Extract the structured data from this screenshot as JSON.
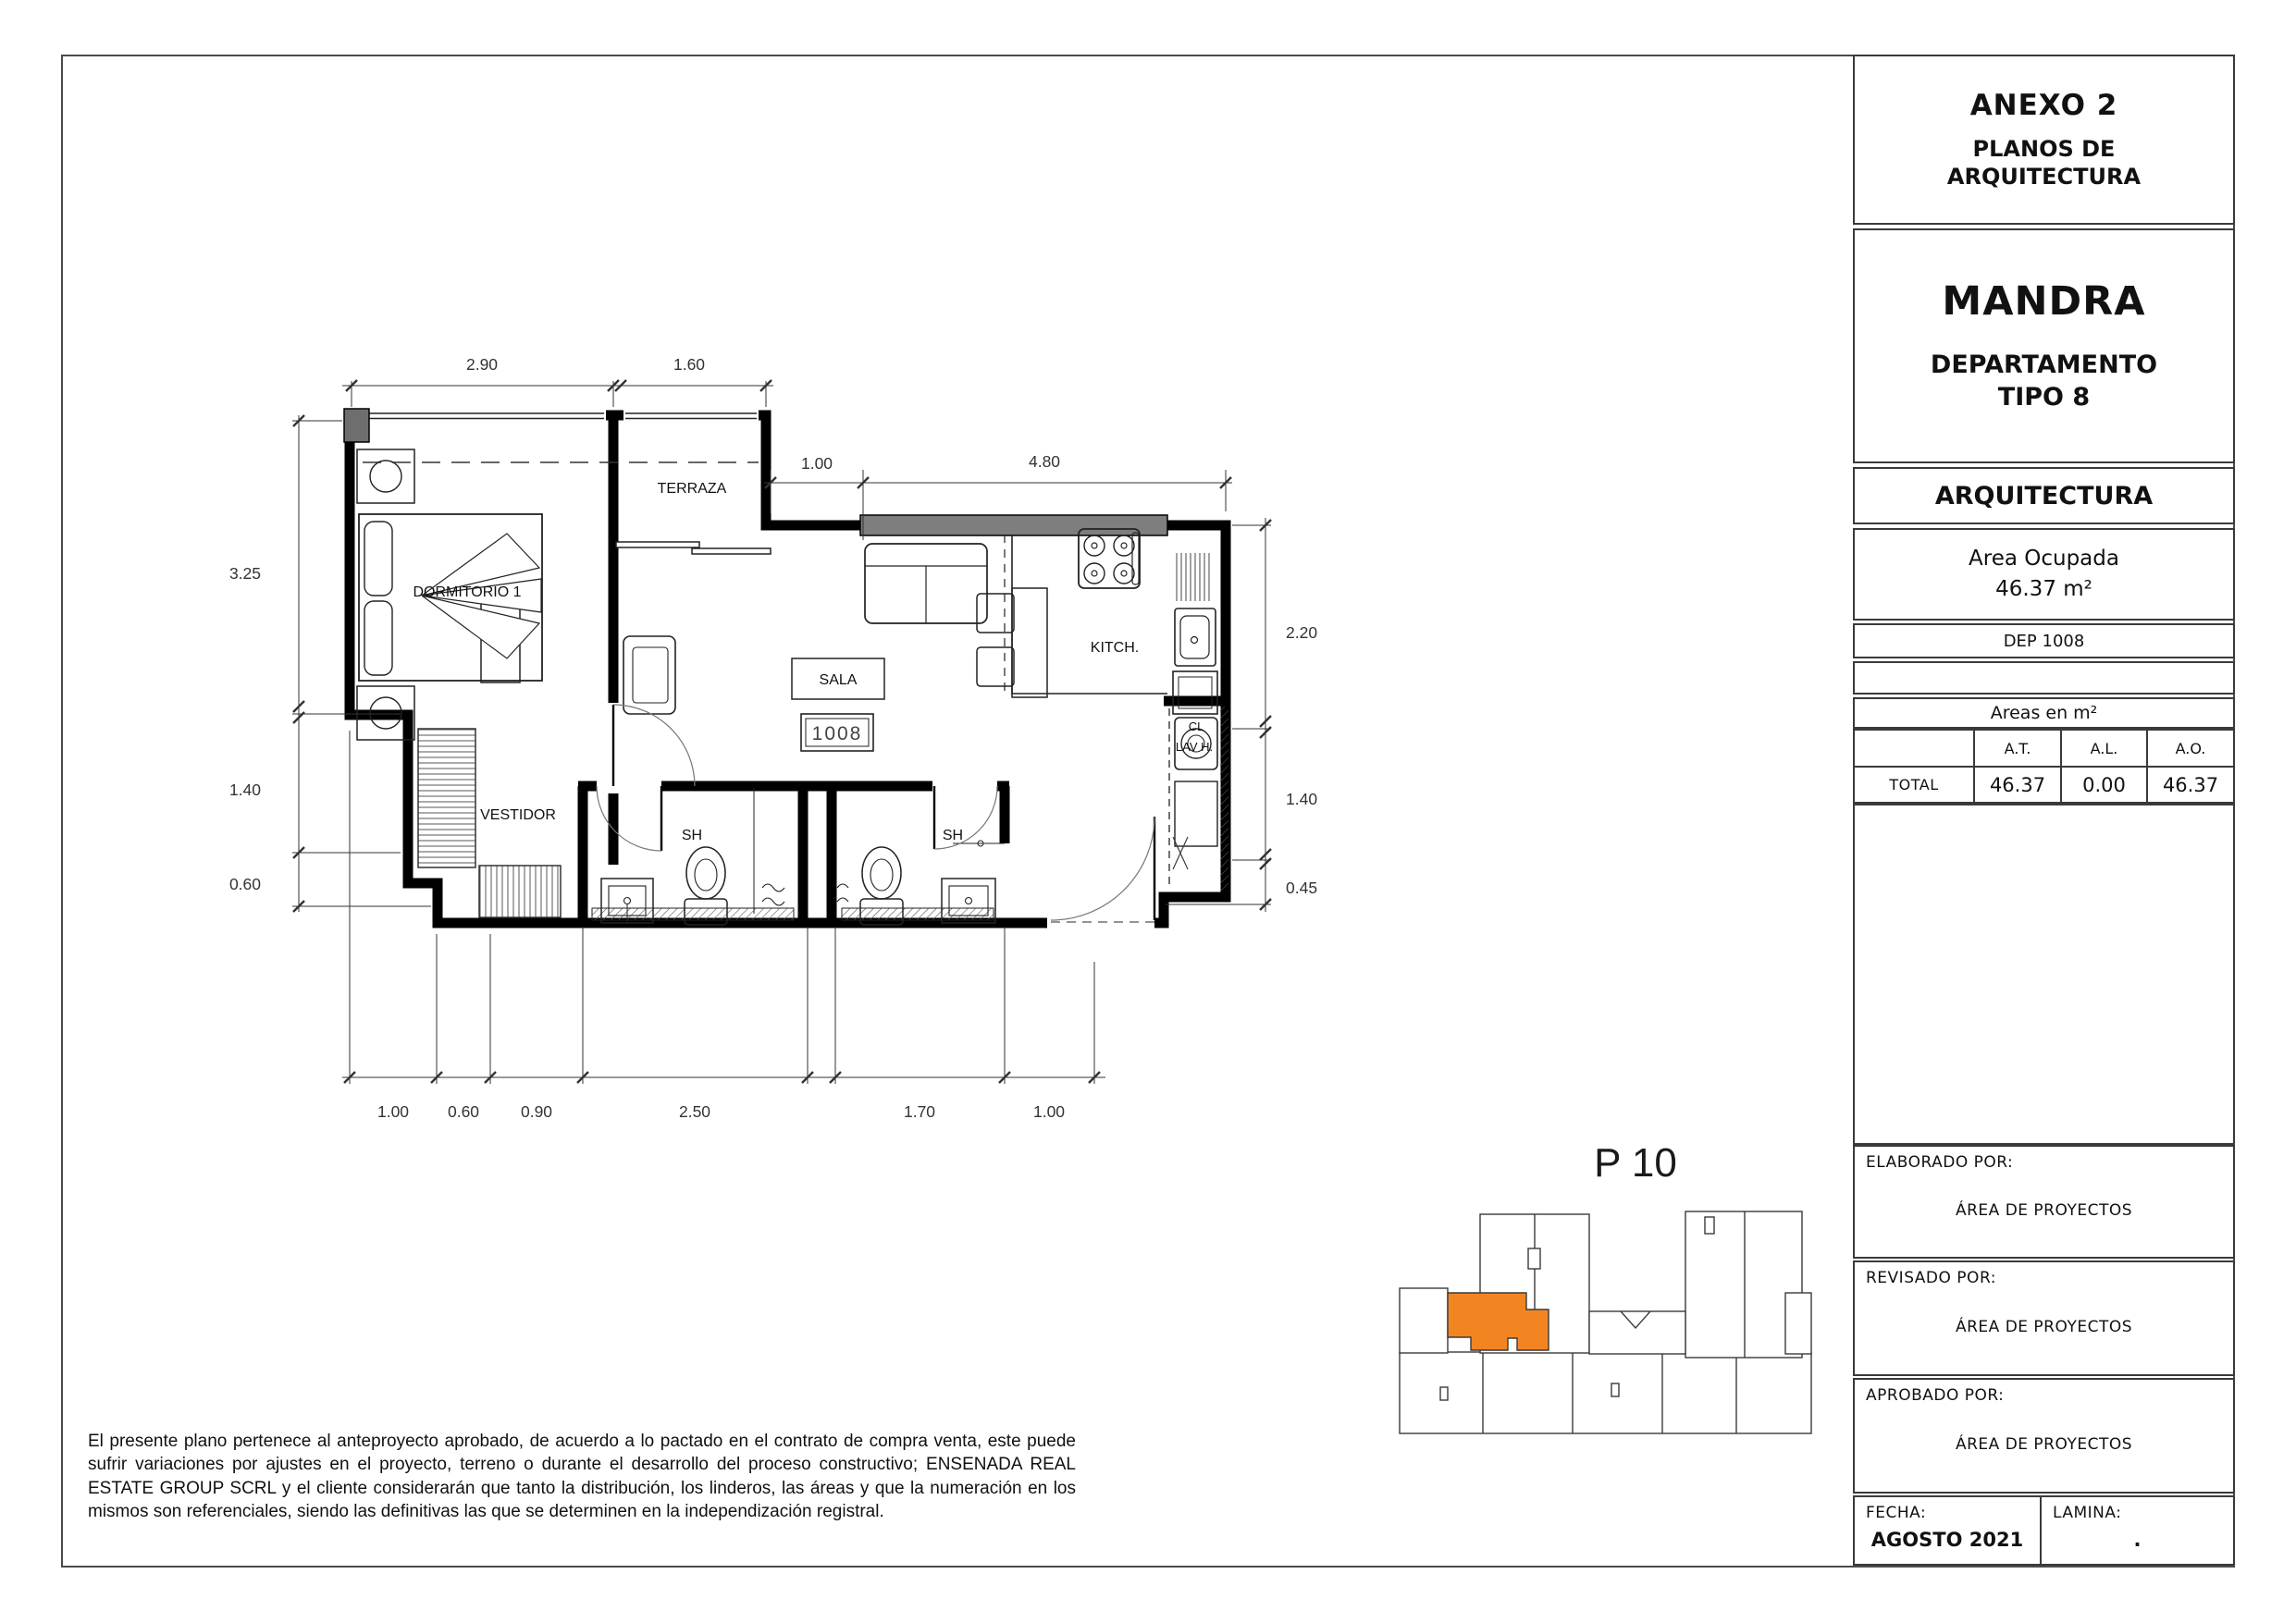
{
  "sheet": {
    "title_block": {
      "annex_title": "ANEXO 2",
      "annex_subtitle_line1": "PLANOS DE",
      "annex_subtitle_line2": "ARQUITECTURA",
      "project_name": "MANDRA",
      "unit_type_line1": "DEPARTAMENTO",
      "unit_type_line2": "TIPO 8",
      "discipline": "ARQUITECTURA",
      "area_label": "Area Ocupada",
      "area_value": "46.37 m²",
      "unit_code": "DEP 1008",
      "areas_table": {
        "title": "Areas en m²",
        "col_at": "A.T.",
        "col_al": "A.L.",
        "col_ao": "A.O.",
        "row_label": "TOTAL",
        "val_at": "46.37",
        "val_al": "0.00",
        "val_ao": "46.37"
      },
      "elaborated_label": "ELABORADO POR:",
      "elaborated_value": "ÁREA DE PROYECTOS",
      "revised_label": "REVISADO POR:",
      "revised_value": "ÁREA DE PROYECTOS",
      "approved_label": "APROBADO POR:",
      "approved_value": "ÁREA DE PROYECTOS",
      "date_label": "FECHA:",
      "date_value": "AGOSTO 2021",
      "sheet_label": "LAMINA:",
      "sheet_value": "."
    },
    "disclaimer": "El presente plano pertenece al anteproyecto aprobado, de acuerdo a lo pactado en el contrato de compra venta, este puede sufrir variaciones por ajustes en el proyecto, terreno o durante el desarrollo del proceso constructivo; ENSENADA REAL ESTATE GROUP SCRL y el cliente considerarán que tanto la distribución, los linderos, las áreas y que la numeración en los mismos son referenciales, siendo las definitivas las que se determinen en la independización registral.",
    "key_plan": {
      "label": "P 10",
      "highlight_color": "#F28522"
    },
    "floor_plan": {
      "unit_tag": "1008",
      "rooms": {
        "bedroom": "DORMITORIO 1",
        "terrace": "TERRAZA",
        "living": "SALA",
        "kitchen": "KITCH.",
        "dressing": "VESTIDOR",
        "bath1": "SH",
        "bath2": "SH",
        "closet": "CL",
        "laundry": "LAV H."
      },
      "dims": {
        "top": [
          "2.90",
          "1.60"
        ],
        "upper": [
          "1.00",
          "4.80"
        ],
        "left": [
          "3.25",
          "1.40",
          "0.60"
        ],
        "right": [
          "2.20",
          "1.40",
          "0.45"
        ],
        "bottom": [
          "1.00",
          "0.60",
          "0.90",
          "2.50",
          "1.70",
          "1.00"
        ]
      }
    }
  }
}
